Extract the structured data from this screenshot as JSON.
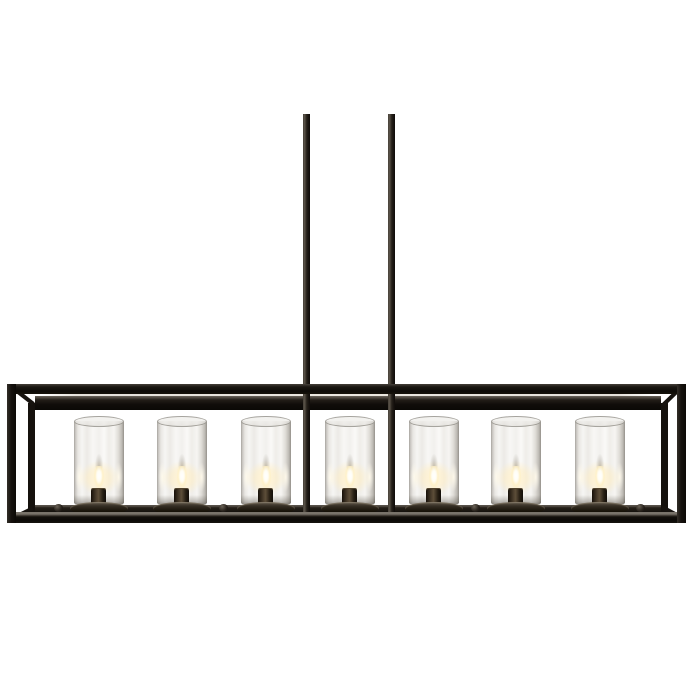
{
  "scene": {
    "background": "#ffffff"
  },
  "colors": {
    "frame": "#17130f",
    "frame_sheen": "#eae6df",
    "bronze": "#4a3d2c",
    "glass_edge": "#a6a39d",
    "glow_core": "#ffffff",
    "glow_warm": "#f7e2ae"
  },
  "fixture": {
    "rods": {
      "width": 7,
      "top_y": 114,
      "bottom_y": 513,
      "x_centers": [
        306,
        391
      ]
    },
    "lights": {
      "count": 7,
      "x_centers": [
        99,
        182,
        266,
        350,
        434,
        516,
        600
      ],
      "unit_top_y": 412,
      "unit_width": 60,
      "unit_height": 104
    },
    "knobs": {
      "x_centers": [
        58,
        223,
        475,
        640
      ],
      "y": 504,
      "size": 9
    }
  }
}
